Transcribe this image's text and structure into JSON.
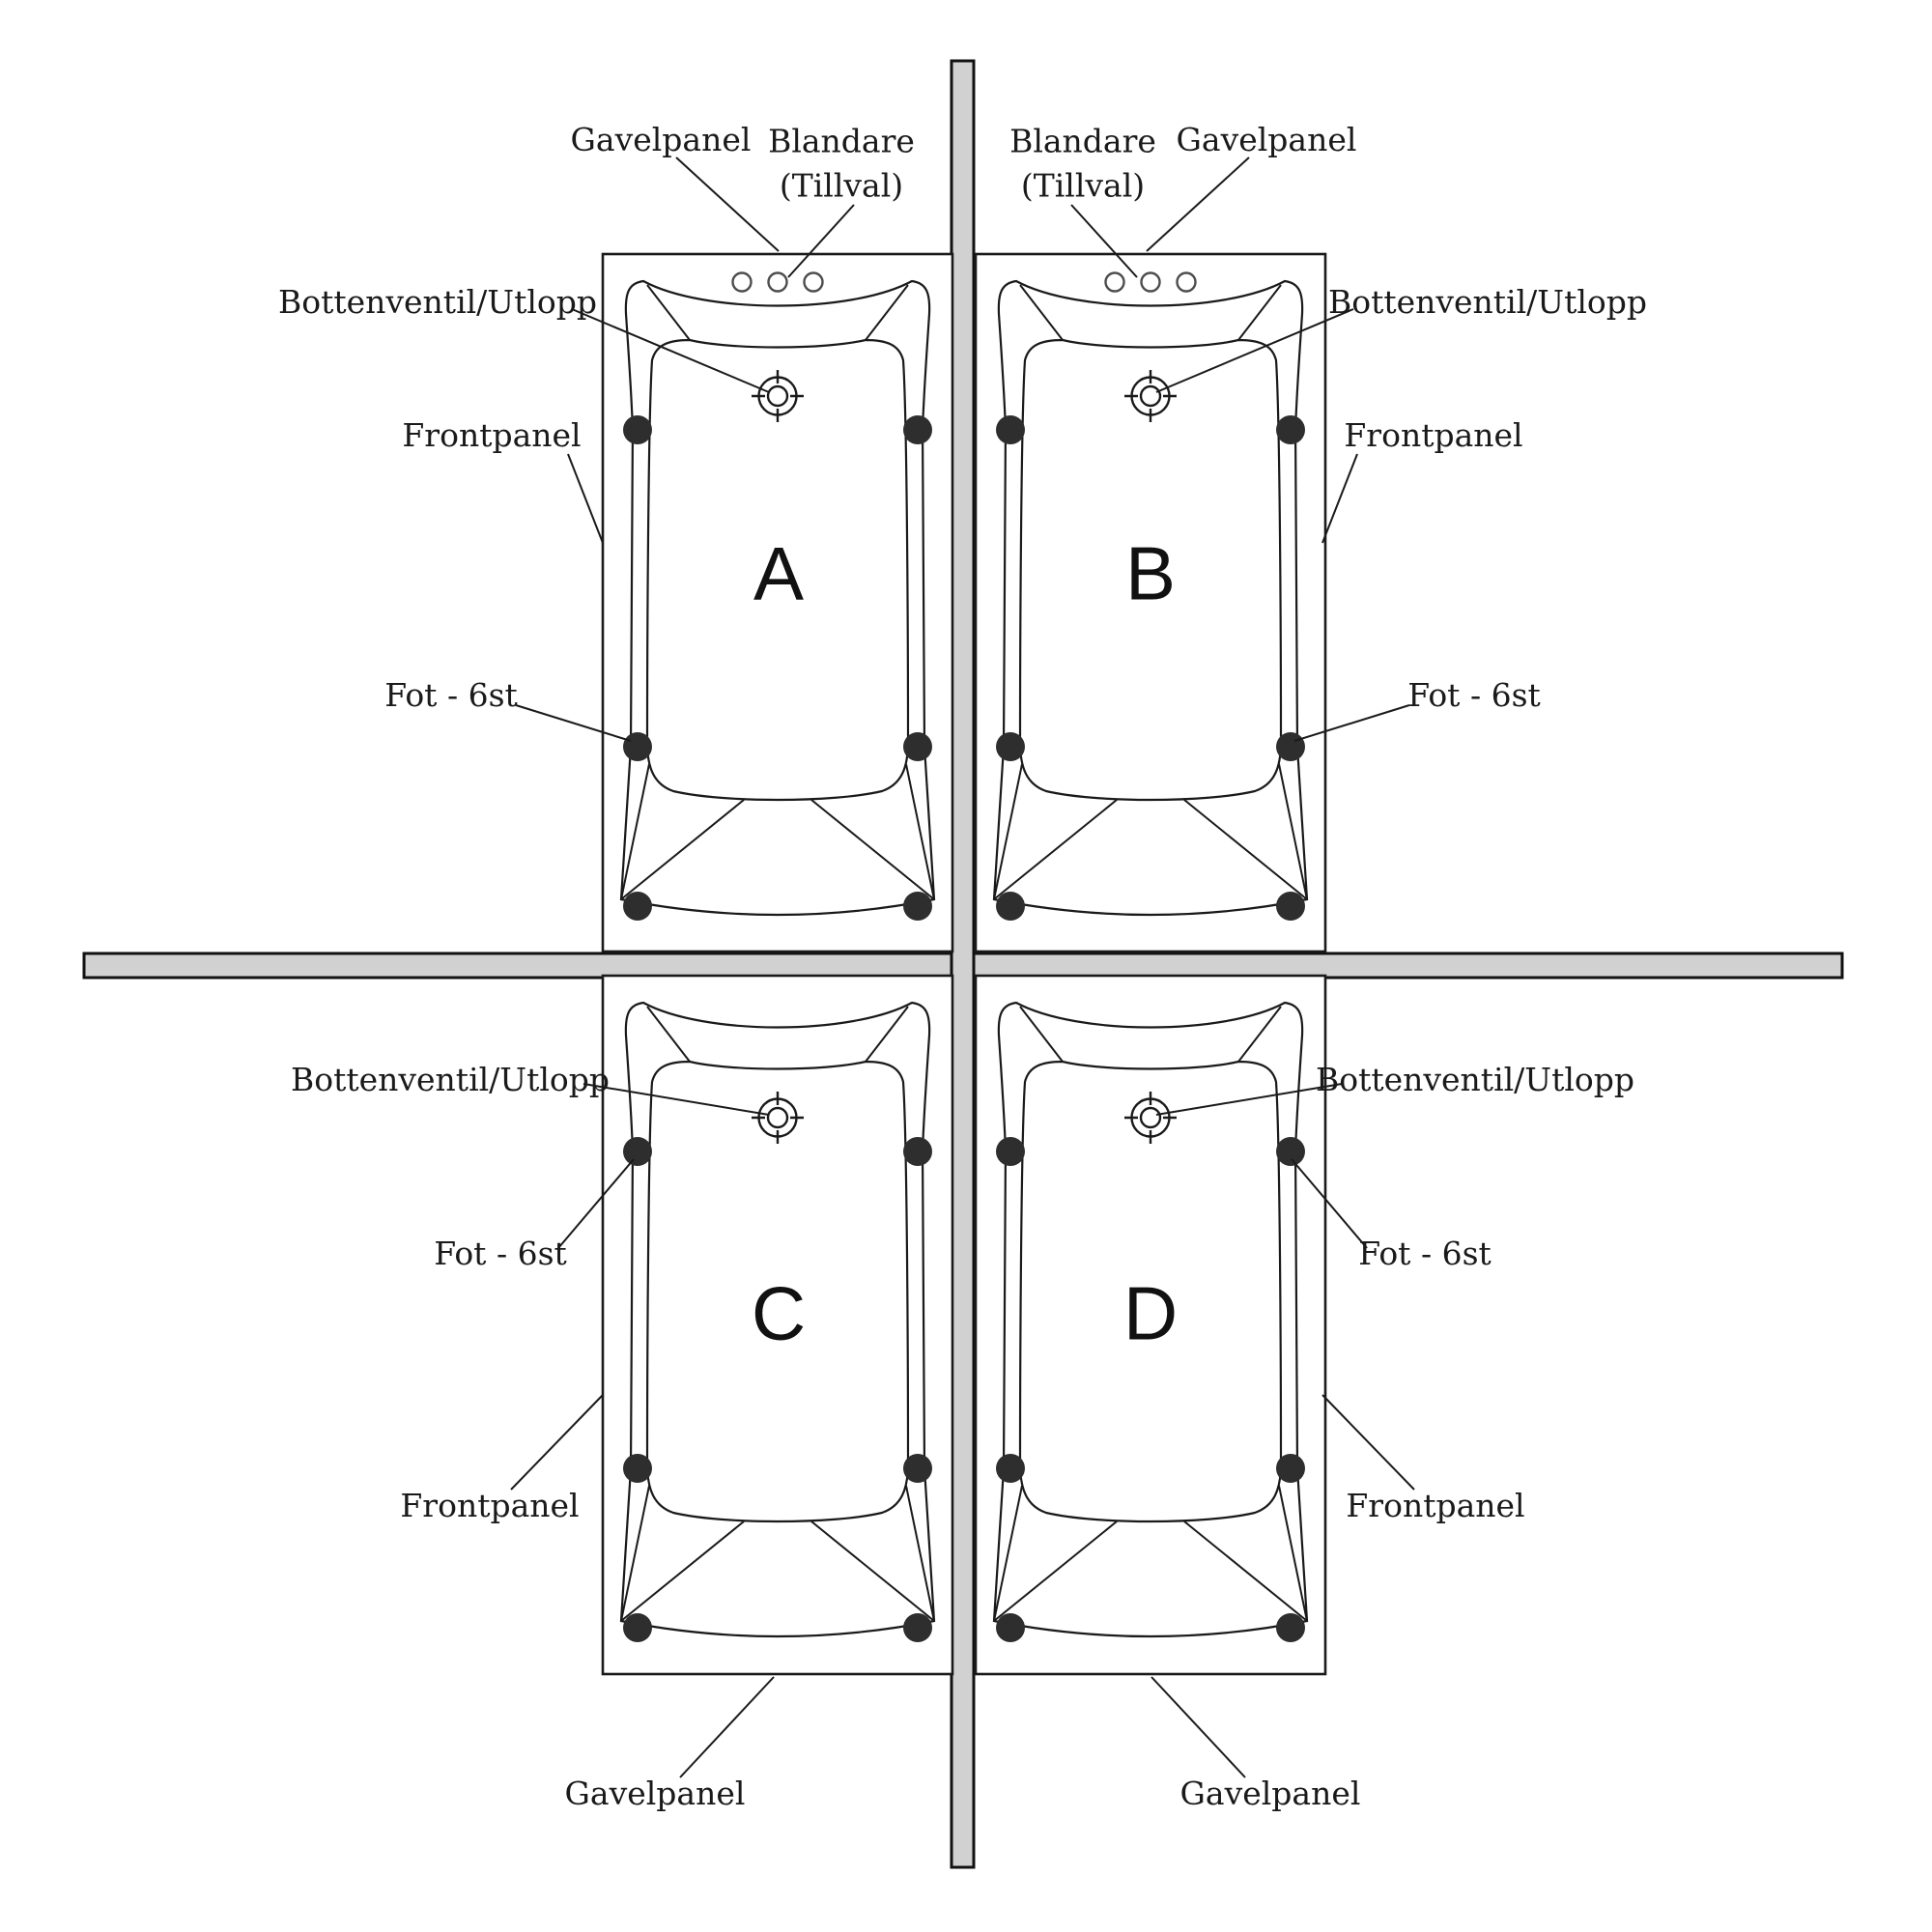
{
  "diagram": {
    "type": "bathtub-installation-plan",
    "labels": {
      "gavelpanel": "Gavelpanel",
      "blandare": "Blandare",
      "tillval": "(Tillval)",
      "bottenventil": "Bottenventil/Utlopp",
      "frontpanel": "Frontpanel",
      "fot": "Fot - 6st"
    },
    "tubs": [
      {
        "letter": "A",
        "position": "top-left",
        "mixer_holes": 3,
        "feet_count": 6
      },
      {
        "letter": "B",
        "position": "top-right",
        "mixer_holes": 3,
        "feet_count": 6
      },
      {
        "letter": "C",
        "position": "bottom-left",
        "mixer_holes": 0,
        "feet_count": 6
      },
      {
        "letter": "D",
        "position": "bottom-right",
        "mixer_holes": 0,
        "feet_count": 6
      }
    ],
    "colors": {
      "background": "#ffffff",
      "wall_fill": "#d1d1d1",
      "line": "#1a1a1a",
      "foot_fill": "#2e2e2e"
    }
  }
}
